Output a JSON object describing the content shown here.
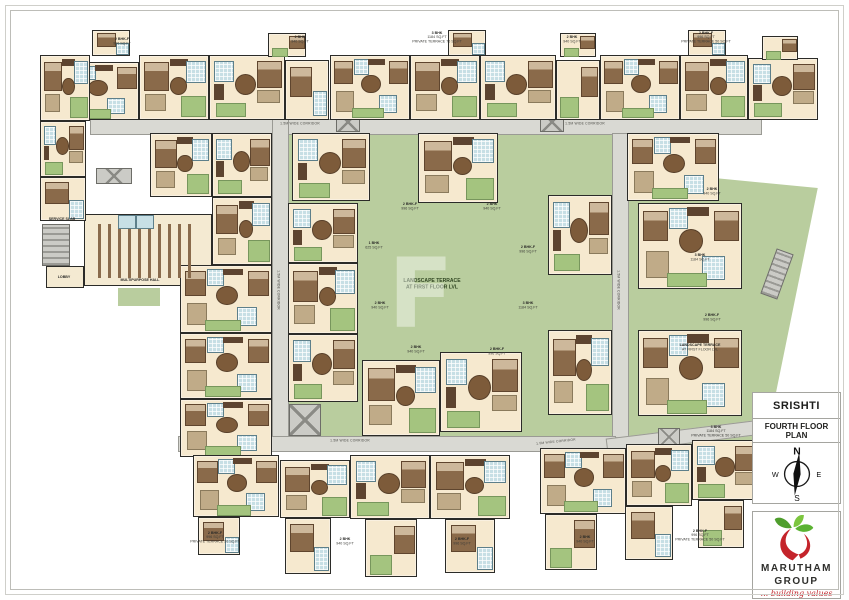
{
  "colors": {
    "courtyard_green": "#b9cd9e",
    "logo_red": "#c4242b",
    "logo_green": "#5bb232",
    "floor_cream": "#f6e9cf",
    "bath_blue": "#c7dfe5"
  },
  "panel": {
    "project_name": "SRISHTI",
    "plan_title": "FOURTH FLOOR PLAN",
    "compass": {
      "n": "N",
      "e": "E",
      "s": "S",
      "w": "W"
    },
    "logo": {
      "name_line1": "MARUTHAM",
      "name_line2": "GROUP",
      "tagline": "... building values"
    }
  },
  "plan": {
    "watermark": "F",
    "courtyard_label_line1": "LANDSCAPE TERRACE",
    "courtyard_label_line2": "AT FIRST FLOOR LVL",
    "corridor_label": "1.5M WIDE CORRIDOR",
    "hall_label": "MULTIPURPOSE HALL",
    "lobby_label": "LOBBY",
    "service_label": "SERVICE SLAB",
    "courtyard": [
      272,
      119,
      355,
      331
    ],
    "right_green": {
      "x": 610,
      "y": 160,
      "w": 212,
      "h": 322,
      "clip": "polygon(1% 2.5%, 98% 8.7%, 70% 99%, 1% 99%)"
    },
    "greens": [
      [
        244,
        96,
        26,
        22
      ],
      [
        586,
        96,
        26,
        22
      ],
      [
        118,
        288,
        42,
        18
      ],
      [
        442,
        420,
        54,
        15
      ],
      [
        598,
        412,
        48,
        22
      ],
      [
        330,
        498,
        26,
        20
      ],
      [
        206,
        98,
        26,
        20
      ],
      [
        700,
        96,
        34,
        22
      ]
    ],
    "corridors": [
      [
        90,
        119,
        670,
        14,
        0
      ],
      [
        272,
        119,
        15,
        331,
        0
      ],
      [
        612,
        133,
        15,
        303,
        0
      ],
      [
        178,
        436,
        436,
        14,
        0
      ],
      [
        606,
        429,
        156,
        13,
        -7
      ]
    ],
    "cores": [
      [
        42,
        224,
        26,
        40,
        "stair",
        0
      ],
      [
        289,
        404,
        30,
        30,
        "lift",
        0
      ],
      [
        336,
        112,
        22,
        18,
        "lift",
        0
      ],
      [
        540,
        112,
        22,
        18,
        "lift",
        0
      ],
      [
        658,
        428,
        20,
        16,
        "lift",
        0
      ],
      [
        768,
        250,
        16,
        46,
        "stair",
        20
      ],
      [
        96,
        168,
        34,
        14,
        "lift",
        0
      ]
    ],
    "hall": {
      "rect": [
        84,
        214,
        128,
        72
      ],
      "seats": [
        98,
        224,
        100,
        54
      ],
      "toilets": [
        [
          118,
          215,
          16,
          12
        ],
        [
          136,
          215,
          16,
          12
        ]
      ],
      "lobby": [
        46,
        266,
        38,
        22
      ]
    },
    "variants": {
      "v1": [
        [
          "bed",
          6,
          10,
          34,
          42
        ],
        [
          "ward",
          44,
          5,
          26,
          11
        ],
        [
          "bath",
          68,
          8,
          26,
          32
        ],
        [
          "sofa",
          8,
          60,
          28,
          24
        ],
        [
          "tbl",
          44,
          34,
          22,
          24
        ],
        [
          "balc",
          60,
          64,
          34,
          30
        ]
      ],
      "v2": [
        [
          "bath",
          6,
          8,
          24,
          30
        ],
        [
          "ward",
          6,
          44,
          13,
          26
        ],
        [
          "tbl",
          34,
          28,
          26,
          30
        ],
        [
          "bed",
          64,
          8,
          30,
          40
        ],
        [
          "sofa",
          64,
          54,
          28,
          18
        ],
        [
          "balc",
          8,
          74,
          38,
          20
        ]
      ],
      "v3": [
        [
          "bed",
          4,
          8,
          22,
          34
        ],
        [
          "bath",
          29,
          5,
          17,
          22
        ],
        [
          "tbl",
          39,
          30,
          22,
          26
        ],
        [
          "bed",
          74,
          8,
          22,
          34
        ],
        [
          "bath",
          62,
          62,
          20,
          26
        ],
        [
          "sofa",
          7,
          56,
          20,
          30
        ],
        [
          "ward",
          47,
          4,
          22,
          10
        ],
        [
          "balc",
          27,
          82,
          38,
          14
        ]
      ],
      "v1s": [
        [
          "bed",
          10,
          10,
          48,
          48
        ],
        [
          "bath",
          64,
          52,
          30,
          40
        ]
      ],
      "v2s": [
        [
          "balc",
          8,
          62,
          40,
          32
        ],
        [
          "bed",
          56,
          10,
          38,
          48
        ]
      ]
    },
    "units": [
      [
        55,
        62,
        84,
        58,
        "v3"
      ],
      [
        139,
        55,
        70,
        65,
        "v1"
      ],
      [
        209,
        55,
        76,
        65,
        "v2"
      ],
      [
        285,
        60,
        44,
        60,
        "v1s"
      ],
      [
        330,
        55,
        80,
        65,
        "v3"
      ],
      [
        410,
        55,
        70,
        65,
        "v1"
      ],
      [
        480,
        55,
        76,
        65,
        "v2"
      ],
      [
        556,
        60,
        44,
        60,
        "v2s"
      ],
      [
        600,
        55,
        80,
        65,
        "v3"
      ],
      [
        680,
        55,
        68,
        65,
        "v1"
      ],
      [
        748,
        58,
        70,
        62,
        "v2"
      ],
      [
        92,
        30,
        38,
        26,
        "v1s"
      ],
      [
        268,
        33,
        38,
        24,
        "v2s"
      ],
      [
        448,
        30,
        38,
        26,
        "v1s"
      ],
      [
        560,
        33,
        36,
        24,
        "v2s"
      ],
      [
        688,
        30,
        38,
        26,
        "v1s"
      ],
      [
        762,
        36,
        36,
        24,
        "v2s"
      ],
      [
        40,
        55,
        50,
        66,
        "v1"
      ],
      [
        40,
        121,
        46,
        56,
        "v2"
      ],
      [
        40,
        177,
        46,
        44,
        "v1s"
      ],
      [
        150,
        133,
        62,
        64,
        "v1"
      ],
      [
        212,
        133,
        60,
        64,
        "v2"
      ],
      [
        212,
        197,
        60,
        68,
        "v1"
      ],
      [
        180,
        265,
        92,
        68,
        "v3"
      ],
      [
        180,
        333,
        92,
        66,
        "v3"
      ],
      [
        180,
        399,
        92,
        58,
        "v3"
      ],
      [
        292,
        133,
        78,
        68,
        "v2"
      ],
      [
        418,
        133,
        80,
        70,
        "v1"
      ],
      [
        288,
        203,
        70,
        60,
        "v2"
      ],
      [
        288,
        263,
        70,
        71,
        "v1"
      ],
      [
        288,
        334,
        70,
        68,
        "v2"
      ],
      [
        548,
        195,
        64,
        80,
        "v2"
      ],
      [
        548,
        330,
        64,
        85,
        "v1"
      ],
      [
        627,
        133,
        92,
        68,
        "v3"
      ],
      [
        638,
        203,
        104,
        86,
        "v3"
      ],
      [
        638,
        330,
        104,
        86,
        "v3"
      ],
      [
        362,
        360,
        78,
        76,
        "v1"
      ],
      [
        440,
        352,
        82,
        80,
        "v2"
      ],
      [
        193,
        455,
        86,
        62,
        "v3"
      ],
      [
        280,
        460,
        70,
        58,
        "v1"
      ],
      [
        350,
        455,
        80,
        64,
        "v2"
      ],
      [
        430,
        455,
        80,
        64,
        "v1"
      ],
      [
        540,
        448,
        86,
        66,
        "v3"
      ],
      [
        626,
        444,
        66,
        62,
        "v1"
      ],
      [
        692,
        440,
        68,
        60,
        "v2"
      ],
      [
        198,
        517,
        42,
        38,
        "v1s"
      ],
      [
        285,
        518,
        46,
        56,
        "v1s"
      ],
      [
        365,
        519,
        52,
        58,
        "v2s"
      ],
      [
        445,
        519,
        50,
        54,
        "v1s"
      ],
      [
        545,
        514,
        52,
        56,
        "v2s"
      ],
      [
        625,
        506,
        48,
        54,
        "v1s"
      ],
      [
        698,
        500,
        46,
        48,
        "v2s"
      ]
    ],
    "corridor_labels": [
      [
        300,
        124,
        0
      ],
      [
        585,
        124,
        0
      ],
      [
        350,
        441,
        0
      ],
      [
        556,
        442,
        -6
      ],
      [
        278,
        290,
        90
      ],
      [
        618,
        290,
        90
      ]
    ],
    "area_labels": [
      {
        "x": 122,
        "y": 42,
        "lines": [
          "2 BHK-F",
          "996 SQ.FT"
        ]
      },
      {
        "x": 300,
        "y": 40,
        "lines": [
          "2 BHK",
          "940 SQ.FT"
        ]
      },
      {
        "x": 437,
        "y": 38,
        "lines": [
          "3 BHK",
          "1184 SQ.FT",
          "PRIVATE TERRACE 75 SQ.FT"
        ]
      },
      {
        "x": 572,
        "y": 40,
        "lines": [
          "2 BHK",
          "940 SQ.FT"
        ]
      },
      {
        "x": 706,
        "y": 38,
        "lines": [
          "2 BHK-F",
          "996 SQ.FT",
          "PRIVATE TERRACE 50 SQ.FT"
        ]
      },
      {
        "x": 410,
        "y": 207,
        "lines": [
          "2 BHK-F",
          "996 SQ.FT"
        ]
      },
      {
        "x": 492,
        "y": 207,
        "lines": [
          "2 BHK",
          "940 SQ.FT"
        ]
      },
      {
        "x": 374,
        "y": 246,
        "lines": [
          "1 BHK",
          "625 SQ.FT"
        ]
      },
      {
        "x": 528,
        "y": 250,
        "lines": [
          "2 BHK-F",
          "996 SQ.FT"
        ]
      },
      {
        "x": 380,
        "y": 306,
        "lines": [
          "2 BHK",
          "940 SQ.FT"
        ]
      },
      {
        "x": 528,
        "y": 306,
        "lines": [
          "3 BHK",
          "1184 SQ.FT"
        ]
      },
      {
        "x": 416,
        "y": 350,
        "lines": [
          "2 BHK",
          "940 SQ.FT"
        ]
      },
      {
        "x": 497,
        "y": 352,
        "lines": [
          "2 BHK-F",
          "996 SQ.FT"
        ]
      },
      {
        "x": 712,
        "y": 192,
        "lines": [
          "2 BHK",
          "940 SQ.FT"
        ]
      },
      {
        "x": 700,
        "y": 258,
        "lines": [
          "3 BHK",
          "1184 SQ.FT"
        ]
      },
      {
        "x": 700,
        "y": 348,
        "lines": [
          "LANDSCAPE TERRACE",
          "AT FIRST FLOOR LVL"
        ]
      },
      {
        "x": 712,
        "y": 318,
        "lines": [
          "2 BHK-F",
          "996 SQ.FT"
        ]
      },
      {
        "x": 716,
        "y": 432,
        "lines": [
          "3 BHK",
          "1184 SQ.FT",
          "PRIVATE TERRACE 50 SQ.FT"
        ]
      },
      {
        "x": 62,
        "y": 220,
        "lines": [
          "SERVICE SLAB"
        ]
      },
      {
        "x": 215,
        "y": 538,
        "lines": [
          "2 BHK-F",
          "996 SQ.FT",
          "PRIVATE TERRACE 50 SQ.FT"
        ]
      },
      {
        "x": 345,
        "y": 542,
        "lines": [
          "2 BHK",
          "940 SQ.FT"
        ]
      },
      {
        "x": 462,
        "y": 542,
        "lines": [
          "2 BHK-F",
          "996 SQ.FT"
        ]
      },
      {
        "x": 585,
        "y": 540,
        "lines": [
          "2 BHK",
          "940 SQ.FT"
        ]
      },
      {
        "x": 700,
        "y": 536,
        "lines": [
          "2 BHK-F",
          "996 SQ.FT",
          "PRIVATE TERRACE 50 SQ.FT"
        ]
      }
    ]
  }
}
